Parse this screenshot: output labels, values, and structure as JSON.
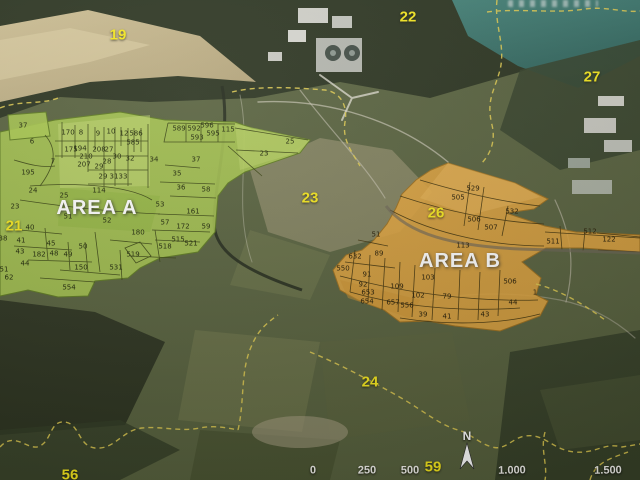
{
  "map": {
    "title_hint": "aerial cadastral map photo",
    "colors": {
      "area_a_fill": "#a9c74e",
      "area_b_fill": "#e0a33c",
      "parcel_line": "#35400e",
      "boundary_dash_yellow": "#ddc94f",
      "zone_label_yellow": "#f6e81c",
      "lake_teal": "#3e7b71",
      "forest_dark": "#29321e",
      "field_tan": "#c9b483"
    }
  },
  "areas": [
    {
      "t": "AREA A",
      "x": 97,
      "y": 208
    },
    {
      "t": "AREA B",
      "x": 460,
      "y": 261
    }
  ],
  "zones": [
    {
      "t": "19",
      "x": 118,
      "y": 35
    },
    {
      "t": "22",
      "x": 408,
      "y": 17
    },
    {
      "t": "27",
      "x": 592,
      "y": 77
    },
    {
      "t": "21",
      "x": 14,
      "y": 226
    },
    {
      "t": "23",
      "x": 310,
      "y": 198
    },
    {
      "t": "26",
      "x": 436,
      "y": 213
    },
    {
      "t": "24",
      "x": 370,
      "y": 382
    },
    {
      "t": "56",
      "x": 70,
      "y": 475
    },
    {
      "t": "59",
      "x": 433,
      "y": 467
    }
  ],
  "parcels_a": [
    {
      "t": "37",
      "x": 23,
      "y": 126
    },
    {
      "t": "6",
      "x": 32,
      "y": 142
    },
    {
      "t": "170",
      "x": 68,
      "y": 133
    },
    {
      "t": "8",
      "x": 81,
      "y": 133
    },
    {
      "t": "9",
      "x": 98,
      "y": 134
    },
    {
      "t": "10",
      "x": 111,
      "y": 132
    },
    {
      "t": "12",
      "x": 124,
      "y": 134
    },
    {
      "t": "586",
      "x": 136,
      "y": 134
    },
    {
      "t": "585",
      "x": 133,
      "y": 143
    },
    {
      "t": "589",
      "x": 179,
      "y": 129
    },
    {
      "t": "592",
      "x": 194,
      "y": 129
    },
    {
      "t": "596",
      "x": 207,
      "y": 126
    },
    {
      "t": "593",
      "x": 197,
      "y": 138
    },
    {
      "t": "595",
      "x": 213,
      "y": 134
    },
    {
      "t": "115",
      "x": 228,
      "y": 130
    },
    {
      "t": "175",
      "x": 71,
      "y": 150
    },
    {
      "t": "194",
      "x": 80,
      "y": 149
    },
    {
      "t": "208",
      "x": 99,
      "y": 150
    },
    {
      "t": "27",
      "x": 109,
      "y": 150
    },
    {
      "t": "210",
      "x": 86,
      "y": 157
    },
    {
      "t": "207",
      "x": 84,
      "y": 165
    },
    {
      "t": "7",
      "x": 53,
      "y": 162
    },
    {
      "t": "28",
      "x": 107,
      "y": 162
    },
    {
      "t": "30",
      "x": 117,
      "y": 157
    },
    {
      "t": "32",
      "x": 130,
      "y": 159
    },
    {
      "t": "29",
      "x": 99,
      "y": 167
    },
    {
      "t": "29",
      "x": 103,
      "y": 177
    },
    {
      "t": "31",
      "x": 114,
      "y": 177
    },
    {
      "t": "33",
      "x": 123,
      "y": 177
    },
    {
      "t": "34",
      "x": 154,
      "y": 160
    },
    {
      "t": "37",
      "x": 196,
      "y": 160
    },
    {
      "t": "35",
      "x": 177,
      "y": 174
    },
    {
      "t": "36",
      "x": 181,
      "y": 188
    },
    {
      "t": "58",
      "x": 206,
      "y": 190
    },
    {
      "t": "195",
      "x": 28,
      "y": 173
    },
    {
      "t": "24",
      "x": 33,
      "y": 191
    },
    {
      "t": "114",
      "x": 99,
      "y": 191
    },
    {
      "t": "25",
      "x": 64,
      "y": 196
    },
    {
      "t": "23",
      "x": 15,
      "y": 207
    },
    {
      "t": "25",
      "x": 290,
      "y": 142
    },
    {
      "t": "23",
      "x": 264,
      "y": 154
    },
    {
      "t": "53",
      "x": 160,
      "y": 205
    },
    {
      "t": "51",
      "x": 68,
      "y": 217
    },
    {
      "t": "52",
      "x": 107,
      "y": 221
    },
    {
      "t": "161",
      "x": 193,
      "y": 212
    },
    {
      "t": "57",
      "x": 165,
      "y": 223
    },
    {
      "t": "172",
      "x": 183,
      "y": 227
    },
    {
      "t": "59",
      "x": 206,
      "y": 227
    },
    {
      "t": "180",
      "x": 138,
      "y": 233
    },
    {
      "t": "40",
      "x": 30,
      "y": 228
    },
    {
      "t": "38",
      "x": 3,
      "y": 239
    },
    {
      "t": "41",
      "x": 21,
      "y": 241
    },
    {
      "t": "45",
      "x": 51,
      "y": 244
    },
    {
      "t": "43",
      "x": 20,
      "y": 252
    },
    {
      "t": "182",
      "x": 39,
      "y": 255
    },
    {
      "t": "48",
      "x": 54,
      "y": 254
    },
    {
      "t": "49",
      "x": 68,
      "y": 255
    },
    {
      "t": "50",
      "x": 83,
      "y": 247
    },
    {
      "t": "515",
      "x": 178,
      "y": 240
    },
    {
      "t": "521",
      "x": 191,
      "y": 244
    },
    {
      "t": "518",
      "x": 165,
      "y": 247
    },
    {
      "t": "519",
      "x": 133,
      "y": 255
    },
    {
      "t": "44",
      "x": 25,
      "y": 264
    },
    {
      "t": "150",
      "x": 81,
      "y": 268
    },
    {
      "t": "62",
      "x": 9,
      "y": 278
    },
    {
      "t": "531",
      "x": 116,
      "y": 268
    },
    {
      "t": "554",
      "x": 69,
      "y": 288
    },
    {
      "t": "51",
      "x": 4,
      "y": 270
    }
  ],
  "parcels_b": [
    {
      "t": "505",
      "x": 458,
      "y": 198
    },
    {
      "t": "529",
      "x": 473,
      "y": 189
    },
    {
      "t": "506",
      "x": 474,
      "y": 220
    },
    {
      "t": "507",
      "x": 491,
      "y": 228
    },
    {
      "t": "532",
      "x": 512,
      "y": 212
    },
    {
      "t": "113",
      "x": 463,
      "y": 246
    },
    {
      "t": "51",
      "x": 376,
      "y": 235
    },
    {
      "t": "632",
      "x": 355,
      "y": 257
    },
    {
      "t": "89",
      "x": 379,
      "y": 254
    },
    {
      "t": "550",
      "x": 343,
      "y": 269
    },
    {
      "t": "91",
      "x": 367,
      "y": 275
    },
    {
      "t": "92",
      "x": 363,
      "y": 285
    },
    {
      "t": "109",
      "x": 397,
      "y": 287
    },
    {
      "t": "103",
      "x": 428,
      "y": 278
    },
    {
      "t": "102",
      "x": 418,
      "y": 296
    },
    {
      "t": "79",
      "x": 447,
      "y": 297
    },
    {
      "t": "653",
      "x": 368,
      "y": 293
    },
    {
      "t": "654",
      "x": 367,
      "y": 302
    },
    {
      "t": "657",
      "x": 393,
      "y": 303
    },
    {
      "t": "556",
      "x": 407,
      "y": 306
    },
    {
      "t": "39",
      "x": 423,
      "y": 315
    },
    {
      "t": "41",
      "x": 447,
      "y": 317
    },
    {
      "t": "43",
      "x": 485,
      "y": 315
    },
    {
      "t": "44",
      "x": 513,
      "y": 303
    },
    {
      "t": "1",
      "x": 535,
      "y": 293
    },
    {
      "t": "511",
      "x": 553,
      "y": 242
    },
    {
      "t": "512",
      "x": 590,
      "y": 232
    },
    {
      "t": "122",
      "x": 609,
      "y": 240
    },
    {
      "t": "506",
      "x": 510,
      "y": 282
    }
  ],
  "scale_bar": {
    "y": 471,
    "labels": [
      {
        "t": "0",
        "x": 313
      },
      {
        "t": "250",
        "x": 367
      },
      {
        "t": "500",
        "x": 410
      },
      {
        "t": "1.000",
        "x": 512
      },
      {
        "t": "1.500",
        "x": 608
      }
    ]
  },
  "north_arrow": {
    "label": "N",
    "x": 467,
    "y": 437
  }
}
